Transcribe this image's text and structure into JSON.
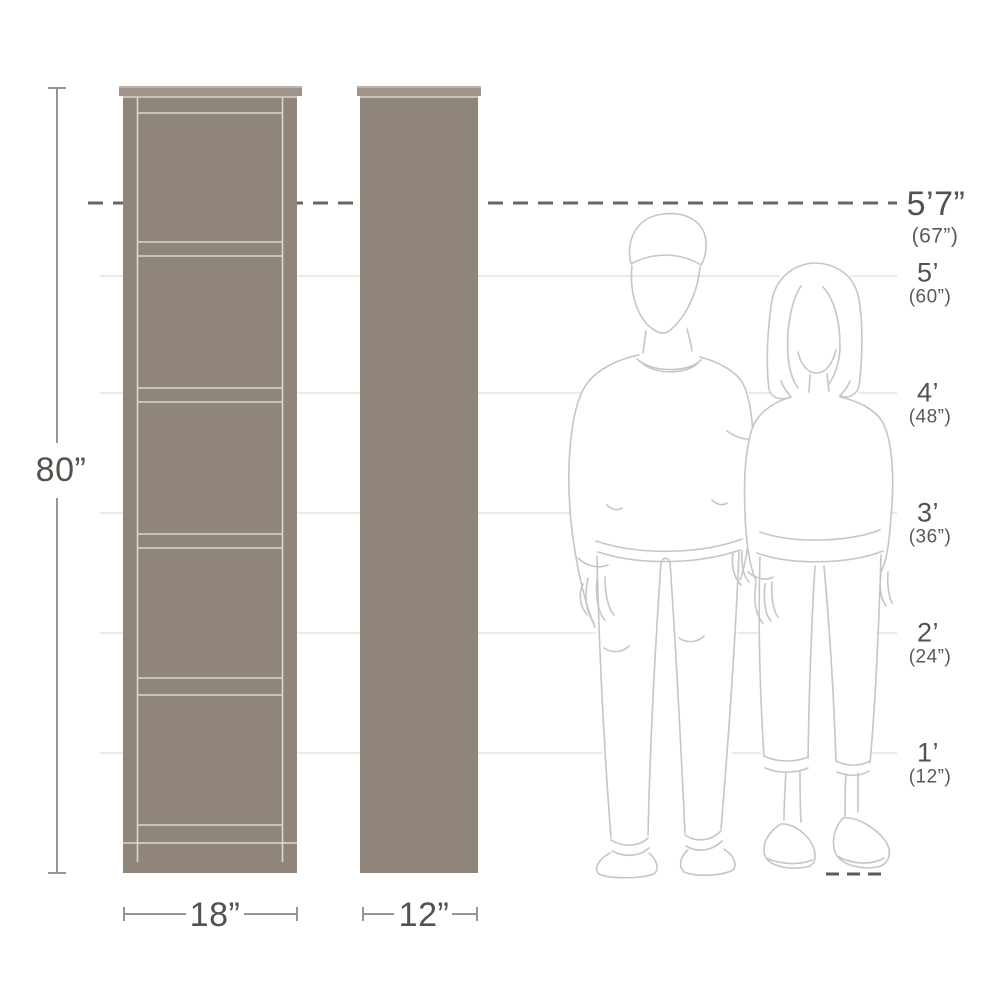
{
  "diagram": {
    "kind": "bookcase-dimensions",
    "unit_height": "80”",
    "front_width": "18”",
    "side_depth": "12”"
  },
  "height_scale": {
    "reference": {
      "feet": "5’7”",
      "inches": "(67”)"
    },
    "markers": [
      {
        "feet": "5’",
        "inches": "(60”)"
      },
      {
        "feet": "4’",
        "inches": "(48”)"
      },
      {
        "feet": "3’",
        "inches": "(36”)"
      },
      {
        "feet": "2’",
        "inches": "(24”)"
      },
      {
        "feet": "1’",
        "inches": "(12”)"
      }
    ]
  },
  "colors": {
    "background": "#ffffff",
    "cabinet_fill": "#8f857b",
    "cabinet_cap": "#9e948b",
    "cabinet_trim": "#ded7ca",
    "dimension_line": "#9c948b",
    "reference_dash": "#6b6560",
    "grid_line": "#e6e3e0",
    "figure_line": "#c9c5c1",
    "text": "#55514c"
  }
}
